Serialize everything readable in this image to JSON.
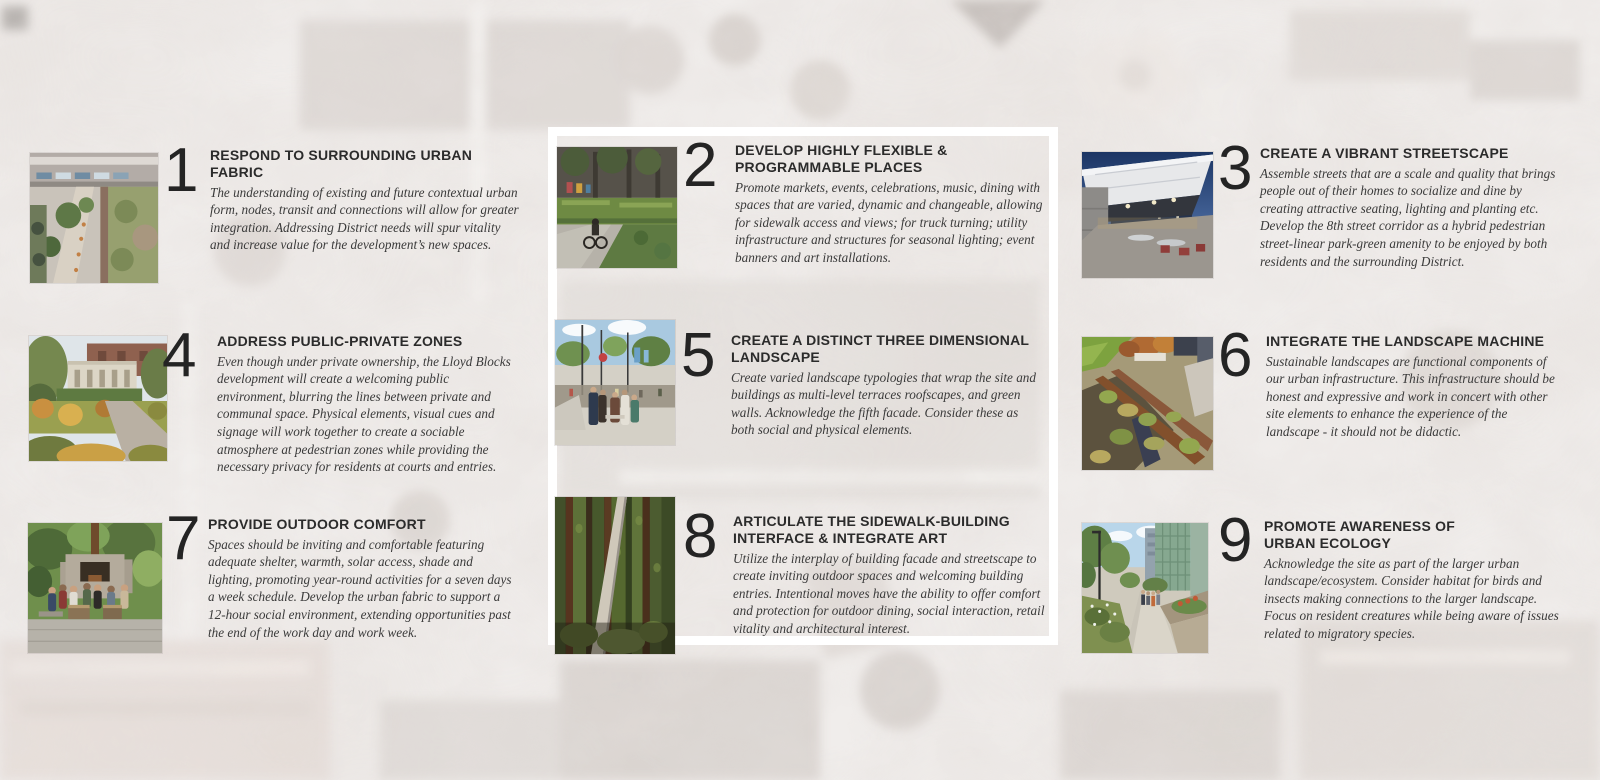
{
  "board": {
    "name": "Lloyd Blocks urban design principles board",
    "items": [
      {
        "number": "1",
        "title": "RESPOND TO SURROUNDING URBAN FABRIC",
        "body": "The understanding of existing and future contextual urban form, nodes, transit and connections will allow for greater integration. Addressing District needs will spur vitality and increase value for the development’s new spaces.",
        "photo": "aerial-courtyard-photo"
      },
      {
        "number": "2",
        "title": "DEVELOP HIGHLY FLEXIBLE & PROGRAMMABLE PLACES",
        "body": "Promote markets, events, celebrations, music, dining with spaces that are varied, dynamic and changeable, allowing for sidewalk access and views; for truck turning; utility infrastructure and structures for seasonal lighting; event banners and art installations.",
        "photo": "child-cycling-plaza-photo"
      },
      {
        "number": "3",
        "title": "CREATE A VIBRANT STREETSCAPE",
        "body": "Assemble streets that are a scale and quality that brings people out of their homes to socialize and dine by creating attractive seating, lighting and planting etc. Develop the 8th street corridor as a hybrid pedestrian street-linear park-green amenity to be enjoyed by both residents and the surrounding District.",
        "photo": "evening-pavilion-photo"
      },
      {
        "number": "4",
        "title": "ADDRESS PUBLIC-PRIVATE ZONES",
        "body": "Even though under private ownership, the Lloyd Blocks development will create a welcoming public environment, blurring the lines between private and communal space. Physical elements, visual cues and signage will work together to create a sociable atmosphere at pedestrian zones while providing the necessary privacy for residents at courts and entries.",
        "photo": "garden-historic-building-photo"
      },
      {
        "number": "5",
        "title": "CREATE A DISTINCT THREE DIMENSIONAL LANDSCAPE",
        "body": "Create varied landscape typologies that wrap the site and buildings as multi-level terraces roofscapes, and green walls. Acknowledge the fifth facade. Consider these as both social and physical elements.",
        "photo": "street-crowd-photo"
      },
      {
        "number": "6",
        "title": "INTEGRATE THE LANDSCAPE MACHINE",
        "body": "Sustainable landscapes are functional components of our urban infrastructure. This infrastructure should be honest and expressive and work in concert with other site elements to enhance the experience of the landscape - it should not be didactic.",
        "photo": "rail-garden-photo"
      },
      {
        "number": "7",
        "title": "PROVIDE OUTDOOR COMFORT",
        "body": "Spaces should be inviting and comfortable featuring adequate shelter, warmth, solar access, shade and lighting, promoting year-round activities for a seven days a week schedule. Develop the urban fabric to support a 12-hour social environment, extending opportunities past the end of the work day and work week.",
        "photo": "outdoor-fireplace-photo"
      },
      {
        "number": "8",
        "title": "ARTICULATE THE SIDEWALK-BUILDING INTERFACE & INTEGRATE ART",
        "body": "Utilize the interplay of building facade and streetscape to create inviting outdoor spaces and welcoming building entries. Intentional moves have the ability to offer comfort and protection for outdoor dining, social interaction, retail vitality and architectural interest.",
        "photo": "green-wall-photo"
      },
      {
        "number": "9",
        "title": "PROMOTE AWARENESS OF URBAN ECOLOGY",
        "body": "Acknowledge the site as part of the larger urban landscape/ecosystem. Consider habitat for birds and insects making connections to the larger landscape. Focus on resident creatures while being aware of issues related to migratory species.",
        "photo": "urban-pathway-photo"
      }
    ]
  },
  "palette": {
    "canvas": "#efecea",
    "frame": "#ffffff",
    "heading_ink": "#2b2b2b",
    "body_ink": "#3a3a3a",
    "number_ink": "#242424"
  }
}
